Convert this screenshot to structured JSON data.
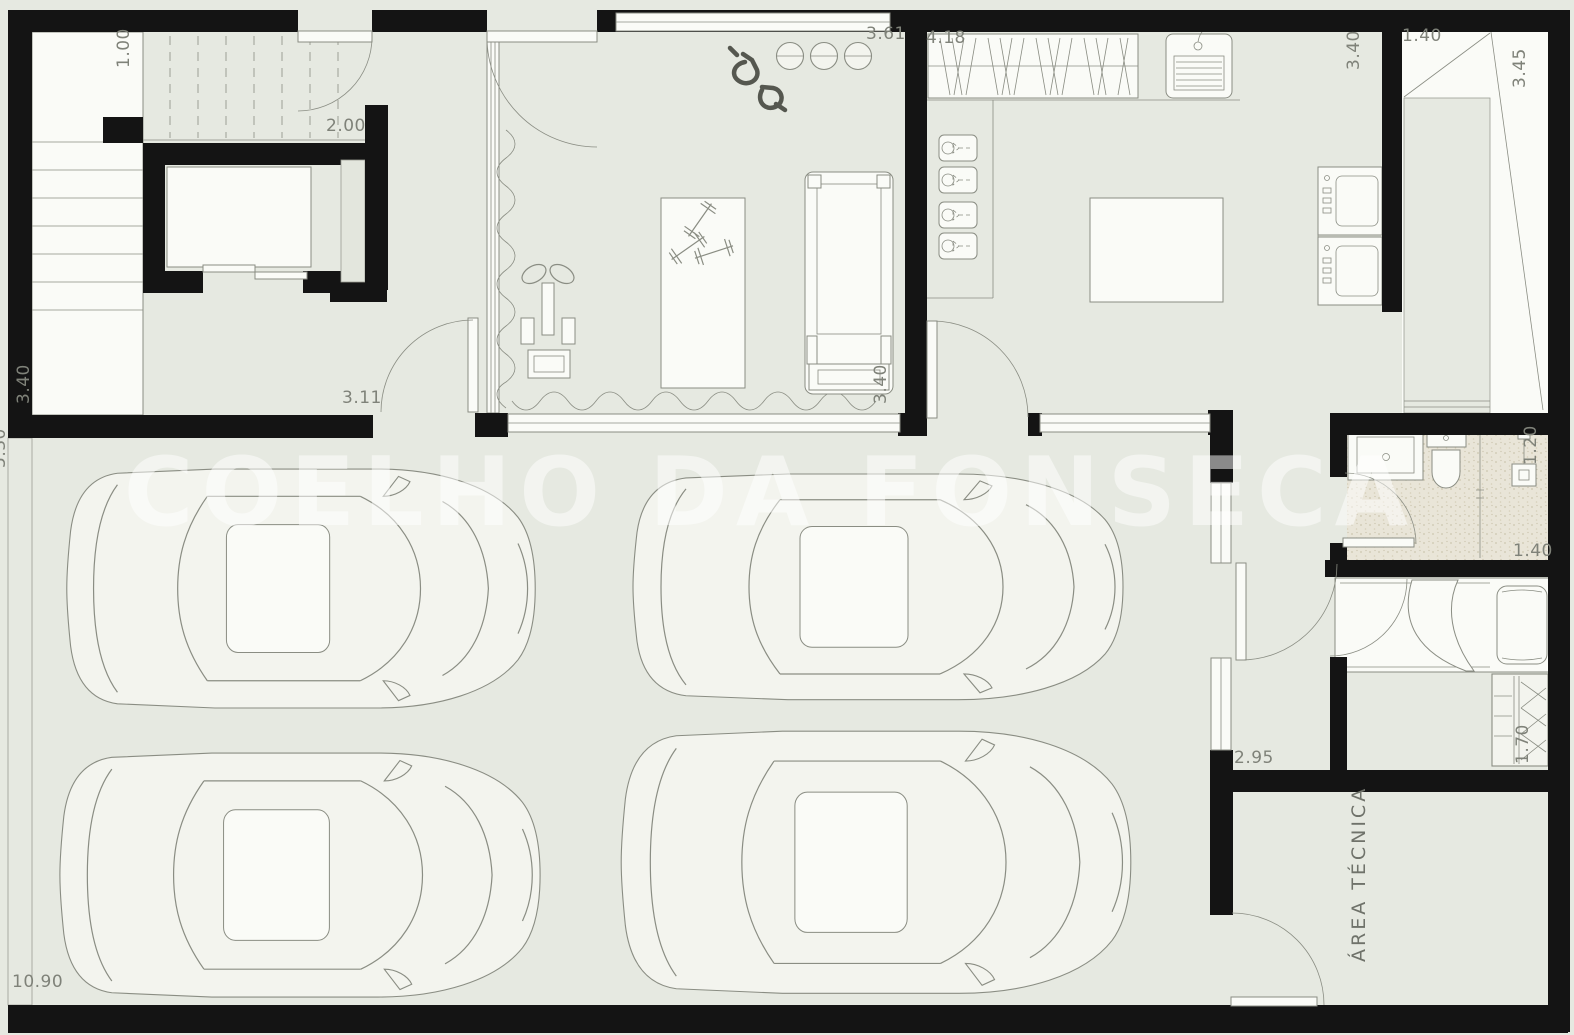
{
  "watermark": {
    "text": "COELHO DA FONSECA"
  },
  "labels": {
    "hall_ramp_width": "1.00",
    "hall_width": "2.00",
    "gym_width": "3.61",
    "laundry_width": "4.18",
    "laundry_depth": "3.40",
    "shaft_width": "1.40",
    "shaft_depth": "3.45",
    "stairs_depth": "3.40",
    "garage_left_depth": "5.30",
    "vestibule_width": "3.11",
    "gym_depth": "3.40",
    "bathroom_depth": "1.20",
    "bathroom_width": "1.40",
    "corridor_length": "2.95",
    "wardrobe_width": "1.70",
    "garage_width": "10.90",
    "technical_area": "ÁREA TÉCNICA"
  },
  "colors": {
    "wall": "#141414",
    "floor": "#e6e9e1",
    "line": "#8a8d83",
    "white_fill": "#fafbf7",
    "bath_floor": "#e9e5d8",
    "label_text": "#7f8279",
    "watermark": "rgba(255,255,255,0.5)"
  }
}
